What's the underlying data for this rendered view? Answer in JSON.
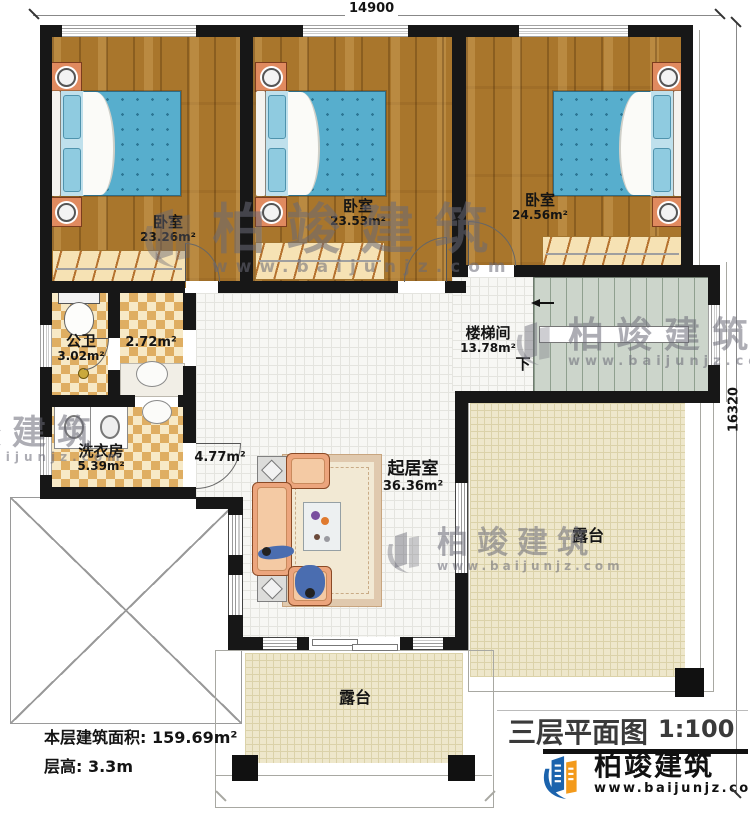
{
  "dimensions": {
    "top": "14900",
    "right": "16320"
  },
  "rooms": {
    "bedroom1": {
      "name": "卧室",
      "area": "23.26m²"
    },
    "bedroom2": {
      "name": "卧室",
      "area": "23.53m²"
    },
    "bedroom3": {
      "name": "卧室",
      "area": "24.56m²"
    },
    "bathroom": {
      "name": "公卫",
      "area": "3.02m²"
    },
    "closet": {
      "area": "2.72m²"
    },
    "laundry": {
      "name": "洗衣房",
      "area": "5.39m²"
    },
    "corridor": {
      "area": "4.77m²"
    },
    "stairwell": {
      "name": "楼梯间",
      "area": "13.78m²",
      "direction": "下"
    },
    "living": {
      "name": "起居室",
      "area": "36.36m²"
    },
    "terraceRight": {
      "name": "露台"
    },
    "terraceBottom": {
      "name": "露台"
    }
  },
  "info": {
    "floor_area": "本层建筑面积: 159.69m²",
    "floor_height": "层高: 3.3m"
  },
  "titleblock": {
    "title": "三层平面图",
    "scale": "1:100"
  },
  "branding": {
    "name": "柏竣建筑",
    "website": "www.baijunjz.com"
  },
  "watermark": {
    "text": "柏竣建筑",
    "url": "www.baijunjz.com"
  },
  "colors": {
    "brand_blue": "#1b63ad",
    "brand_orange": "#f39a1b",
    "wall_black": "#171717"
  }
}
